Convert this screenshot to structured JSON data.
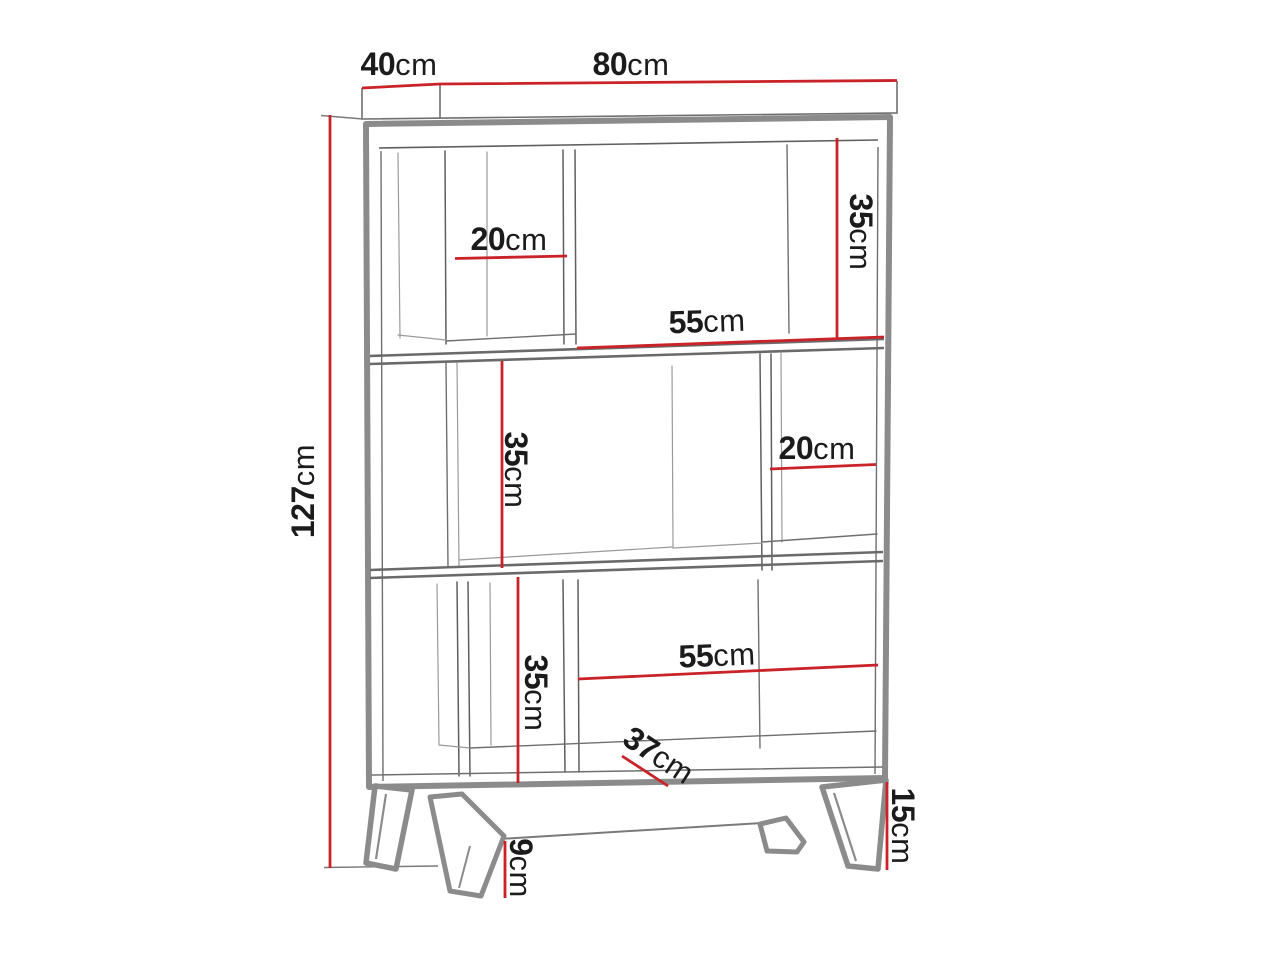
{
  "figure": {
    "type": "furniture-dimension-diagram",
    "subject": "three-tier bookcase with splayed legs"
  },
  "colors": {
    "dimension_red": "#c92329",
    "frame_gray": "#8b8b8b",
    "detail_gray": "#5f5f5f",
    "faint_gray": "#9a9a9a",
    "text_black": "#1b1b1b",
    "background": "#ffffff"
  },
  "dimensions": {
    "depth": {
      "value": "40",
      "unit": "cm"
    },
    "width": {
      "value": "80",
      "unit": "cm"
    },
    "height": {
      "value": "127",
      "unit": "cm"
    },
    "top_cubby_width": {
      "value": "20",
      "unit": "cm"
    },
    "top_row_height": {
      "value": "35",
      "unit": "cm"
    },
    "top_open_width": {
      "value": "55",
      "unit": "cm"
    },
    "middle_row_height": {
      "value": "35",
      "unit": "cm"
    },
    "middle_cubby_width": {
      "value": "20",
      "unit": "cm"
    },
    "bottom_row_height": {
      "value": "35",
      "unit": "cm"
    },
    "bottom_open_width": {
      "value": "55",
      "unit": "cm"
    },
    "bottom_depth": {
      "value": "37",
      "unit": "cm"
    },
    "leg_clearance": {
      "value": "9",
      "unit": "cm"
    },
    "leg_height": {
      "value": "15",
      "unit": "cm"
    }
  }
}
